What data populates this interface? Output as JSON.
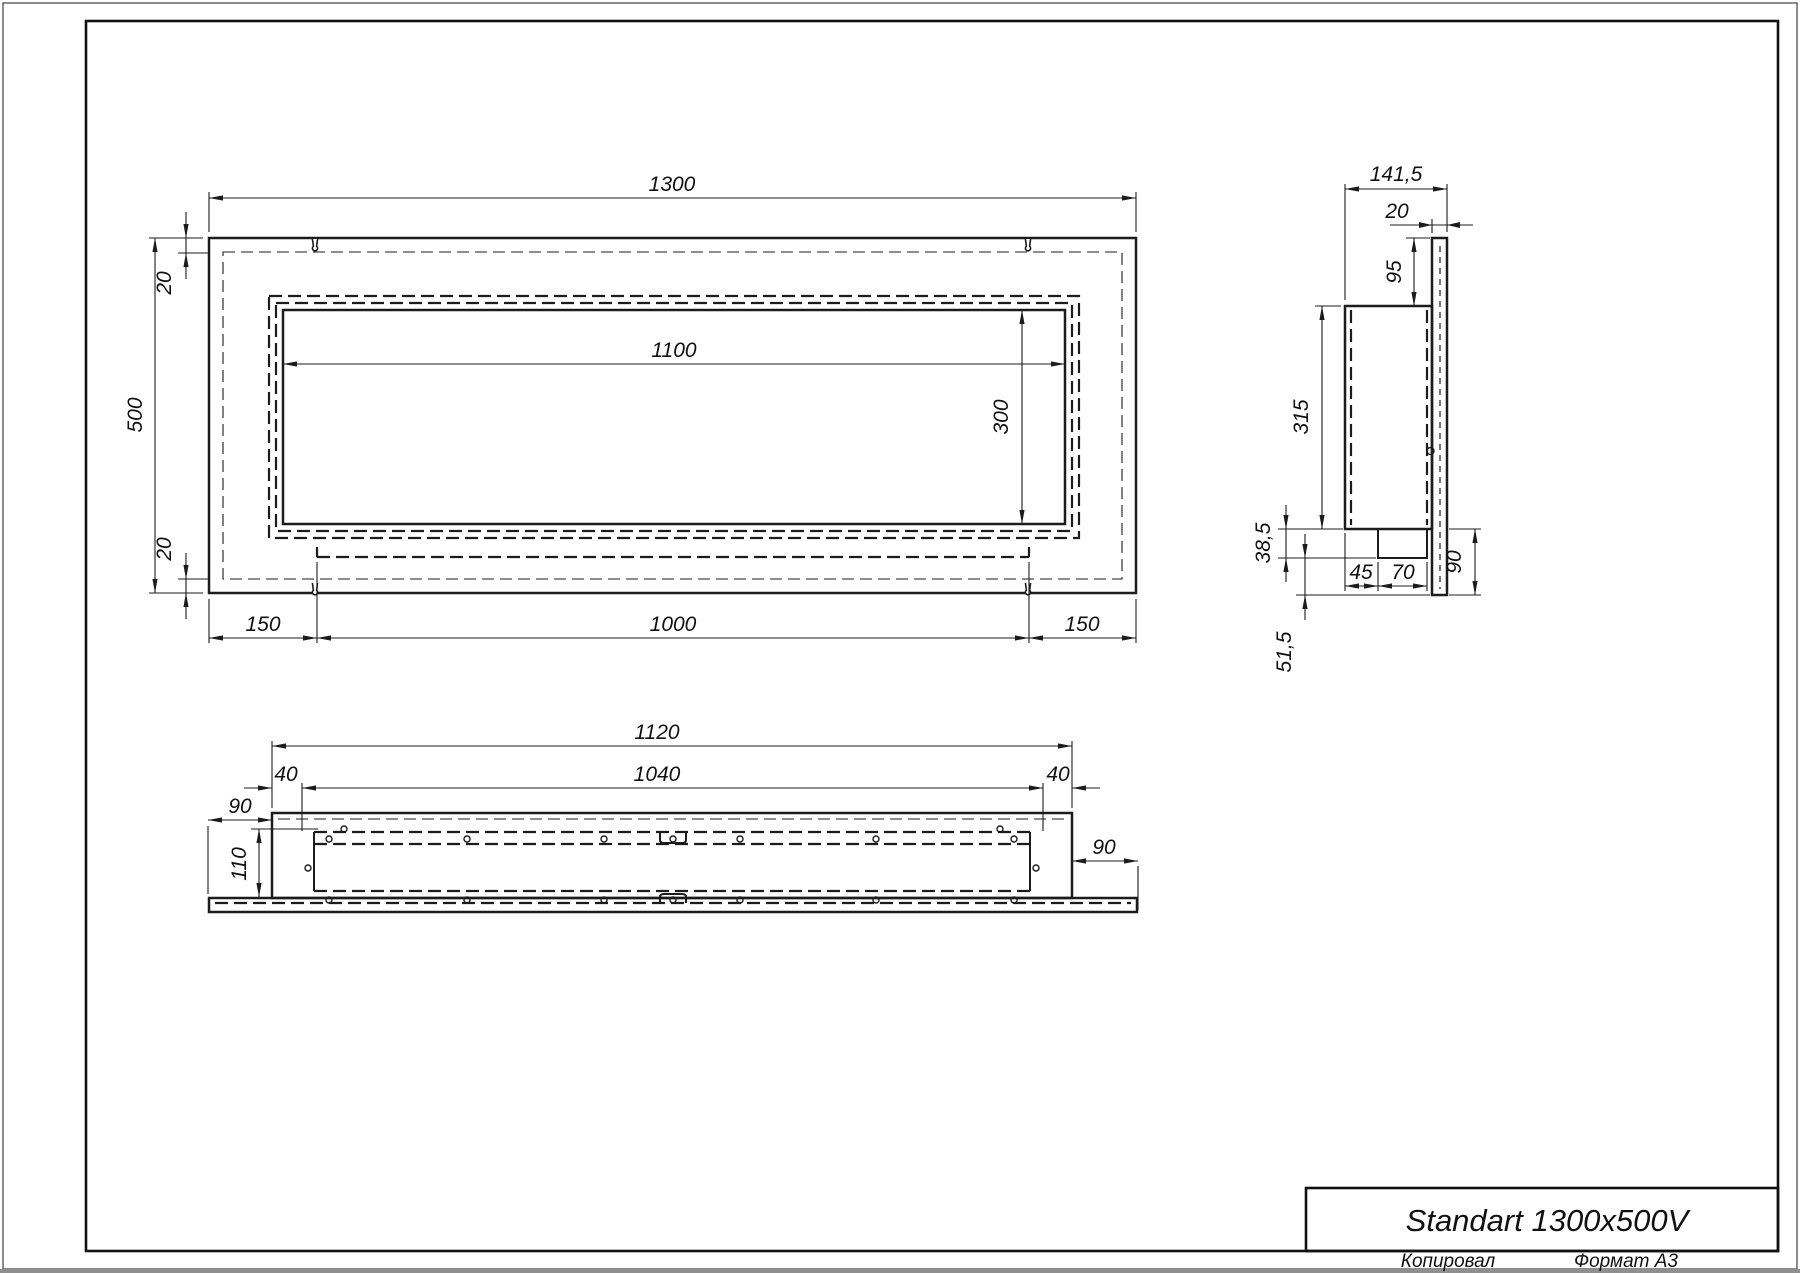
{
  "window": {
    "title": "Standart 1300x500V",
    "footer_copied": "Копировал",
    "footer_format": "Формат А3"
  },
  "front_view": {
    "overall_width": "1300",
    "overall_height": "500",
    "flange_offset_top": "20",
    "flange_offset_bottom": "20",
    "opening_width": "1100",
    "opening_height": "300",
    "mount_left": "150",
    "mount_span": "1000",
    "mount_right": "150"
  },
  "side_view": {
    "overall_depth": "141,5",
    "flange_thickness": "20",
    "top_to_body": "95",
    "body_height": "315",
    "burner_drop": "38,5",
    "burner_setback": "45",
    "burner_depth": "70",
    "bottom_zone": "90",
    "flange_below": "51,5"
  },
  "bottom_view": {
    "body_length": "1120",
    "inner_length": "1040",
    "margin_left": "40",
    "margin_right": "40",
    "flange_overhang_left": "90",
    "flange_overhang_right": "90",
    "body_inner_depth": "110"
  }
}
